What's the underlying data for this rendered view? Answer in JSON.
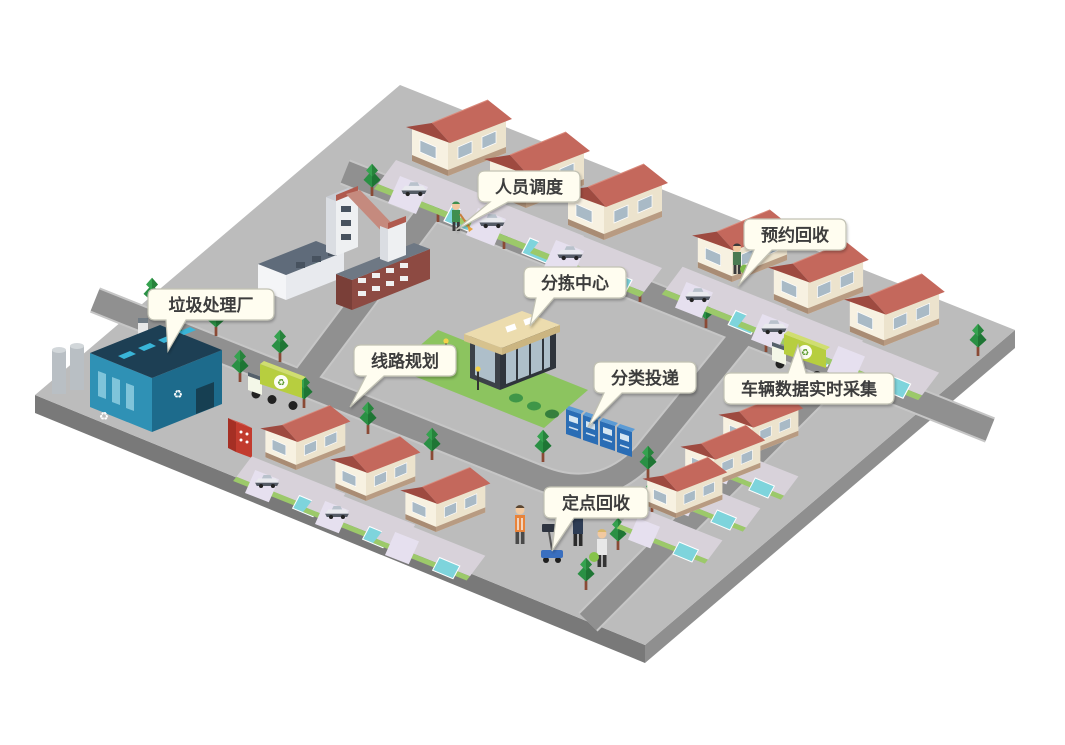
{
  "callouts": {
    "personnel_dispatch": "人员调度",
    "appointment_recycling": "预约回收",
    "waste_treatment_plant": "垃圾处理厂",
    "sorting_center": "分拣中心",
    "route_planning": "线路规划",
    "classified_delivery": "分类投递",
    "vehicle_realtime_data": "车辆数据实时采集",
    "fixed_point_recycling": "定点回收"
  },
  "icons": {
    "recycle_symbol": "♻"
  },
  "colors": {
    "platform": "#bcbcbc",
    "platform_side": "#8f8f8f",
    "platform_side_dark": "#797979",
    "road": "#909090",
    "roof_red": "#c4685c",
    "roof_red_dark": "#9e4a40",
    "wall_cream": "#f7f1e1",
    "lawn_green": "#8cc45f",
    "truck_green": "#b7ce3f",
    "bins_blue": "#2a6db5",
    "plant_blue": "#2f91b5",
    "tree_green": "#2a9044",
    "bubble_fill": "#fffdf0",
    "bubble_border": "#c2c2b4",
    "label_text": "#3c3c3c"
  }
}
